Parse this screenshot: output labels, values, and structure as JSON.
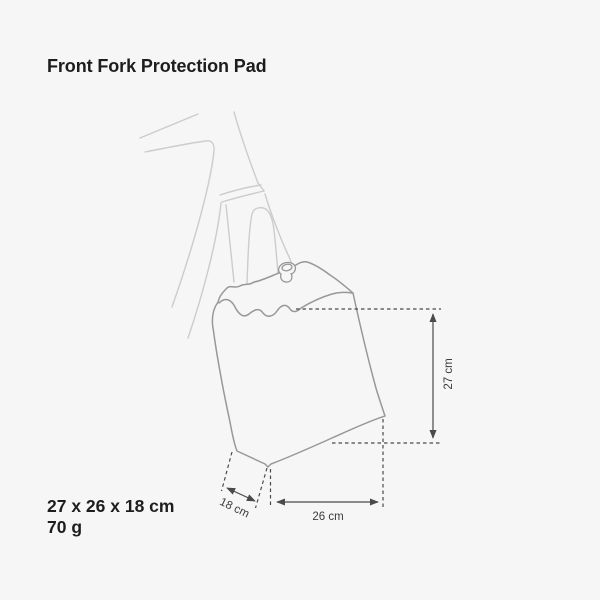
{
  "page": {
    "background_color": "#f6f6f6"
  },
  "title": "Front Fork Protection Pad",
  "specs": {
    "dimensions": "27 x 26 x 18 cm",
    "weight": "70 g"
  },
  "diagram": {
    "labels": {
      "height": "27 cm",
      "width": "26 cm",
      "depth": "18 cm"
    },
    "colors": {
      "frame_line": "#cccccd",
      "pad_line": "#98989b",
      "dimension_line": "#4a4a4a",
      "label_text": "#3c3c3c",
      "heading_text": "#1d1d1d"
    }
  }
}
